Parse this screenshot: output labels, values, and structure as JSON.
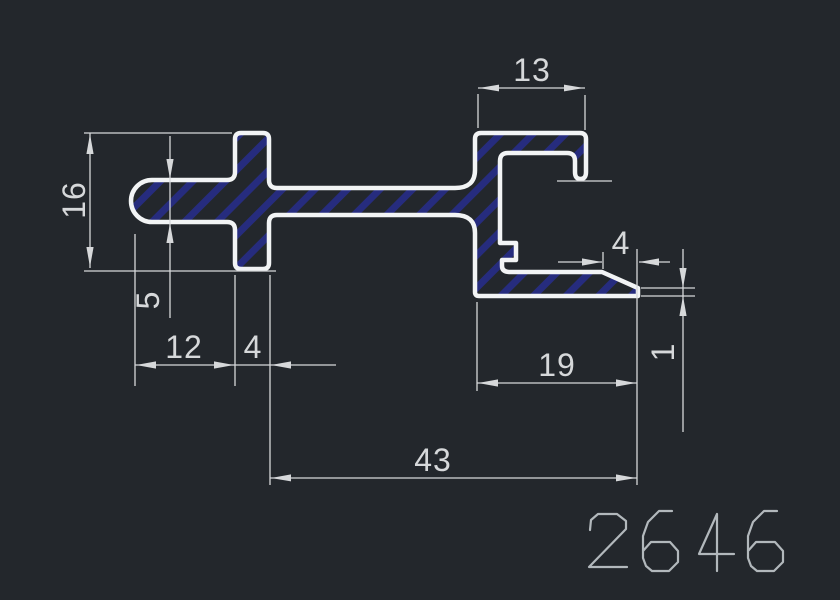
{
  "drawing": {
    "title": "aluminum-profile-cross-section",
    "part_number": "2646",
    "dimensions": {
      "top_width": "13",
      "left_height": "16",
      "arm_thickness": "5",
      "arm_offset": "12",
      "stem_width": "4",
      "taper_length": "4",
      "tip_thickness": "1",
      "flange_depth": "19",
      "overall_width": "43"
    },
    "colors": {
      "background": "#23272c",
      "outline": "#f2f4f5",
      "hatch": "#262c7e",
      "dimension": "#d6d8da",
      "part_number_color": "#b2b8bc"
    }
  }
}
